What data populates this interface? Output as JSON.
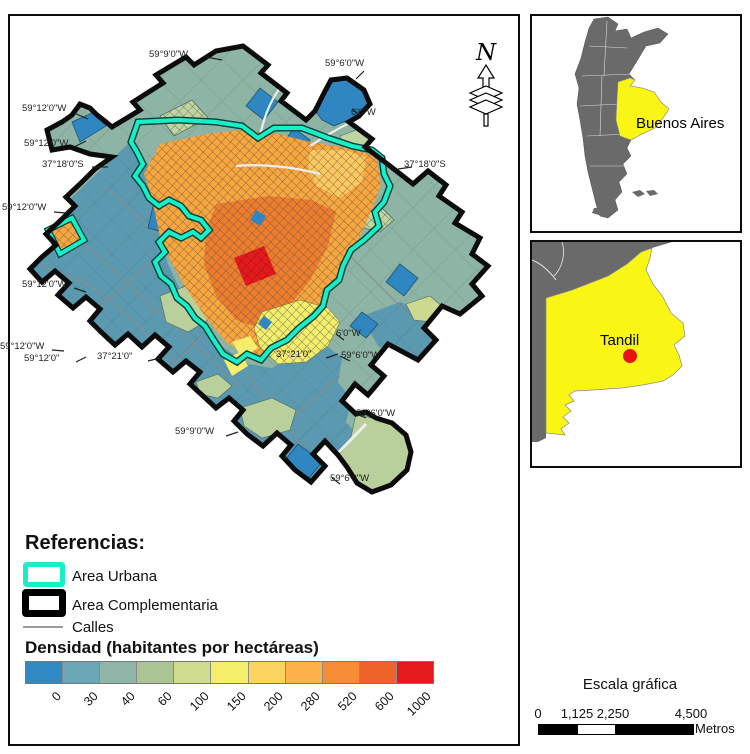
{
  "main_map": {
    "north_label": "N",
    "coord_labels": [
      {
        "text": "59°9'0\"W"
      },
      {
        "text": "59°6'0\"W"
      },
      {
        "text": "6'0\"W"
      },
      {
        "text": "59°12'0\"W"
      },
      {
        "text": "59°12'0\"W"
      },
      {
        "text": "37°18'0\"S"
      },
      {
        "text": "37°18'0\"S"
      },
      {
        "text": "59°12'0\"W"
      },
      {
        "text": "59°12'0\"W"
      },
      {
        "text": "59°12'0\"W"
      },
      {
        "text": "59°12'0\""
      },
      {
        "text": "37°21'0\""
      },
      {
        "text": "37°21'0\""
      },
      {
        "text": "6'0\"W"
      },
      {
        "text": "59°6'0\"W"
      },
      {
        "text": "59°6'0\"W"
      },
      {
        "text": "59°9'0\"W"
      },
      {
        "text": "59°6'0\"W"
      }
    ]
  },
  "legend": {
    "title": "Referencias:",
    "items": [
      {
        "label": "Area Urbana"
      },
      {
        "label": "Area Complementaria"
      },
      {
        "label": "Calles"
      }
    ],
    "density_title": "Densidad (habitantes por hectáreas)",
    "density_breaks": [
      "0",
      "30",
      "40",
      "60",
      "100",
      "150",
      "200",
      "280",
      "520",
      "600",
      "1000"
    ],
    "density_colors": [
      "#3089c3",
      "#69a6b6",
      "#8fb5a7",
      "#aac493",
      "#cedc8c",
      "#f4ee6b",
      "#fdd35f",
      "#fdb14b",
      "#f68d35",
      "#ee6428",
      "#e41a1c"
    ]
  },
  "insets": {
    "argentina_label": "Buenos Aires",
    "province_label": "Tandil"
  },
  "scale_bar": {
    "title": "Escala gráfica",
    "ticks": [
      "0",
      "1,125",
      "2,250",
      "4,500"
    ],
    "unit": "Metros"
  },
  "colors": {
    "urban_boundary": "#18efc9",
    "complementary_boundary": "#000000",
    "streets": "#9a9a9a",
    "sage": "#8db4a5",
    "teal": "#5b99b0",
    "highlight_yellow": "#f9f616",
    "country_gray": "#6a6a6a",
    "marker_red": "#e8140f"
  }
}
